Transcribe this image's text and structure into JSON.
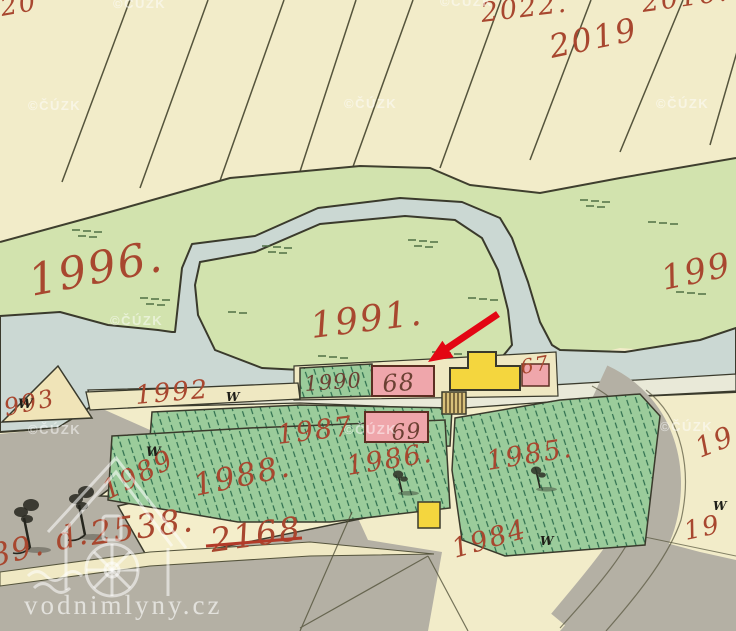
{
  "map": {
    "region_type": "historical cadastral map",
    "labels": {
      "top_left_partial": "20",
      "f2022": "2022.",
      "f2019": "2019",
      "f2016": "2016.",
      "m1996": "1996.",
      "m1991": "1991.",
      "m199_right": "199",
      "p993": "993",
      "p1992": "1992",
      "p1990": "1990",
      "p1987": "1987",
      "p1986": "1986.",
      "p1985": "1985.",
      "p1984": "1984",
      "p1989": "1989",
      "p1988": "1988.",
      "p2538": "2538.",
      "p2168": "2168",
      "bottom_left_partial": "889. d.",
      "r19_upper": "19",
      "r19_lower": "19"
    },
    "building_labels": {
      "b68": "68",
      "b69": "69",
      "b67": "67"
    },
    "symbols": {
      "meadow_w": "W"
    },
    "watermarks": {
      "cuzk": "©ČÚZK",
      "site": "vodnimlyny.cz"
    },
    "colors": {
      "paper": "#f2ecc9",
      "meadow": "#d2e3ae",
      "garden_hatch": "#9bcc9b",
      "water": "#cbd8d3",
      "road_gray": "#b4b0a4",
      "building_pink": "#efa6ab",
      "building_yellow": "#f4d63e",
      "ink_red": "#a8472f",
      "arrow_red": "#e30613"
    }
  }
}
